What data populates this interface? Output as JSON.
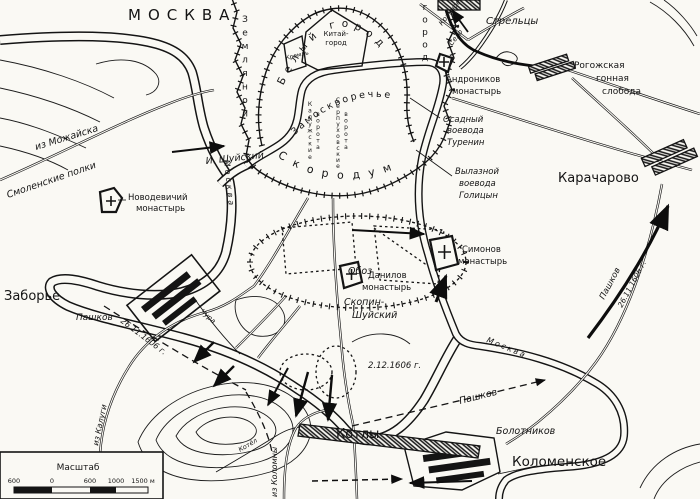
{
  "map": {
    "title": "МОСКВА",
    "ink": "#141414",
    "paper": "#faf9f4",
    "labels": {
      "zemlyanoy": {
        "text": "Земляной"
      },
      "gorod_right": {
        "text": "город"
      },
      "bely_gorod": {
        "text": "Белый город"
      },
      "kitay1": {
        "text": "Китай-"
      },
      "kitay2": {
        "text": "город"
      },
      "kreml": {
        "text": "Кремль"
      },
      "zamoskvorechye": {
        "text": "Замоскворечье"
      },
      "skorodum": {
        "text": "Скородум"
      },
      "kaluzh1": {
        "text": "Калужские"
      },
      "kaluzh2": {
        "text": "ворота"
      },
      "serp1": {
        "text": "Серпуховские"
      },
      "serp2": {
        "text": "ворота"
      },
      "i_shuysky": {
        "text": "И. Шуйский"
      },
      "novodev1": {
        "text": "Новодевичий"
      },
      "novodev2": {
        "text": "монастырь"
      },
      "iz_mozhayska": {
        "text": "из Можайска"
      },
      "smolenskie": {
        "text": "Смоленские полки"
      },
      "zaborye": {
        "text": "Заборье"
      },
      "pashkov_w": {
        "text": "Пашков"
      },
      "iz_kalugi": {
        "text": "из Калуги"
      },
      "date_w": {
        "text": "26.11.1606 г."
      },
      "chura": {
        "text": "Чура"
      },
      "moskva_w": {
        "text": "Москва"
      },
      "moskva_e": {
        "text": "Москва"
      },
      "oboz": {
        "text": "Обоз"
      },
      "danilov1": {
        "text": "Данилов"
      },
      "danilov2": {
        "text": "монастырь"
      },
      "skopin1": {
        "text": "Скопин-"
      },
      "skopin2": {
        "text": "Шуйский"
      },
      "simonov1": {
        "text": "Симонов"
      },
      "simonov2": {
        "text": "монастырь"
      },
      "golitsyn1": {
        "text": "Вылазной"
      },
      "golitsyn2": {
        "text": "воевода"
      },
      "golitsyn3": {
        "text": "Голицын"
      },
      "turenin1": {
        "text": "Осадный"
      },
      "turenin2": {
        "text": "воевода"
      },
      "turenin3": {
        "text": "Туренин"
      },
      "karacharovo": {
        "text": "Карачарово"
      },
      "streltsy": {
        "text": "Стрельцы"
      },
      "krasnoe1": {
        "text": "Красное"
      },
      "krasnoe2": {
        "text": "Село"
      },
      "andron1": {
        "text": "Андроников"
      },
      "andron2": {
        "text": "монастырь"
      },
      "rogozh1": {
        "text": "Рогожская"
      },
      "rogozh2": {
        "text": "гонная"
      },
      "rogozh3": {
        "text": "слобода"
      },
      "pashkov_e": {
        "text": "Пашков"
      },
      "date_e": {
        "text": "26.11.1606 г."
      },
      "date_c": {
        "text": "2.12.1606 г."
      },
      "pashkov_s": {
        "text": "Пашков"
      },
      "bolotnikov": {
        "text": "Болотников"
      },
      "kolomenskoye": {
        "text": "Коломенское"
      },
      "kotly": {
        "text": "Котлы"
      },
      "iz_kolomny": {
        "text": "из Коломны"
      },
      "kotel": {
        "text": "Котёл"
      }
    },
    "scale": {
      "title": "Масштаб",
      "ticks": [
        "600",
        "0",
        "600",
        "1000",
        "1500 м"
      ]
    }
  }
}
